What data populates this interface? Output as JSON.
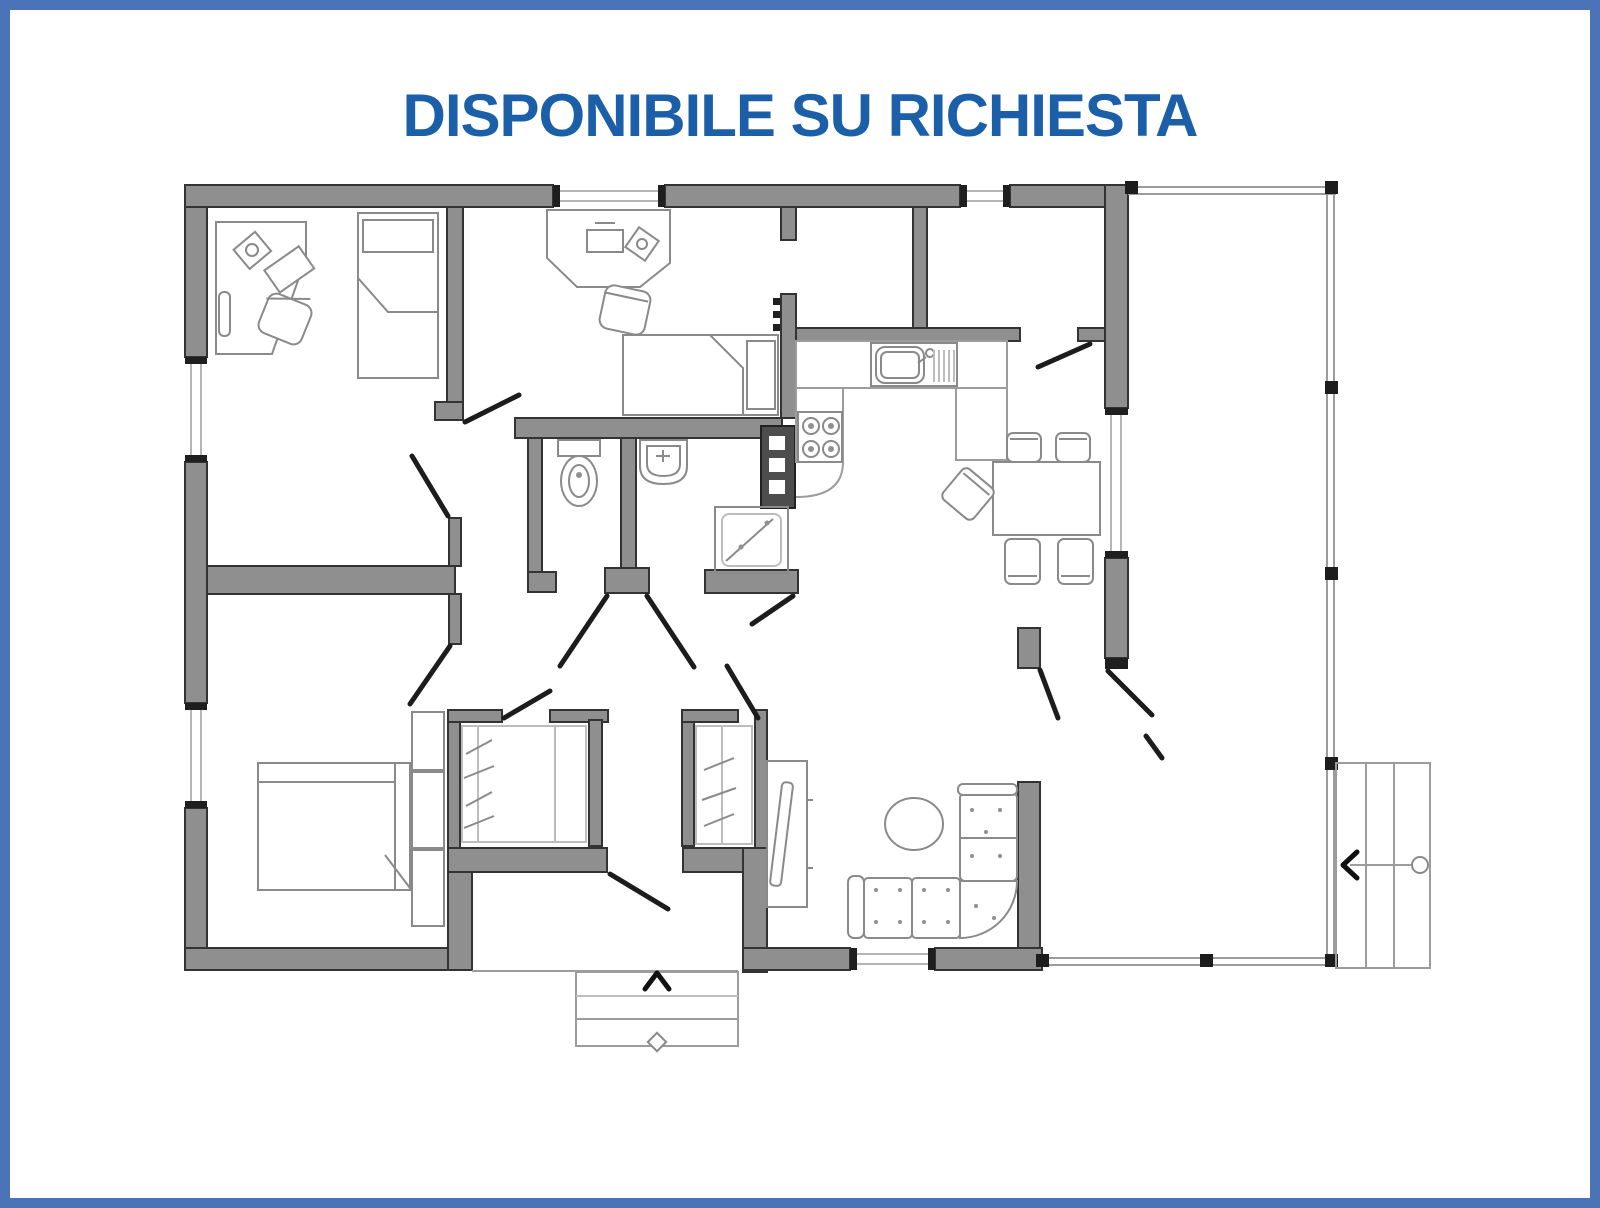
{
  "title": "DISPONIBILE SU RICHIESTA",
  "colors": {
    "border": "#4a73b8",
    "title": "#1a5fa8",
    "background": "#ffffff",
    "wall_fill": "#8f8f8f",
    "wall_stroke": "#333333",
    "door_line": "#1c1c1c",
    "furniture_line": "#8a8a8a",
    "light_line": "#b5b5b5",
    "boiler_fill": "#4d4d4d"
  },
  "icons": {
    "entry-direction-arrow": "chevron-up",
    "terrace-steps-arrow": "chevron-left",
    "entry-steps-marker": "diamond",
    "terrace-steps-marker": "circle"
  }
}
